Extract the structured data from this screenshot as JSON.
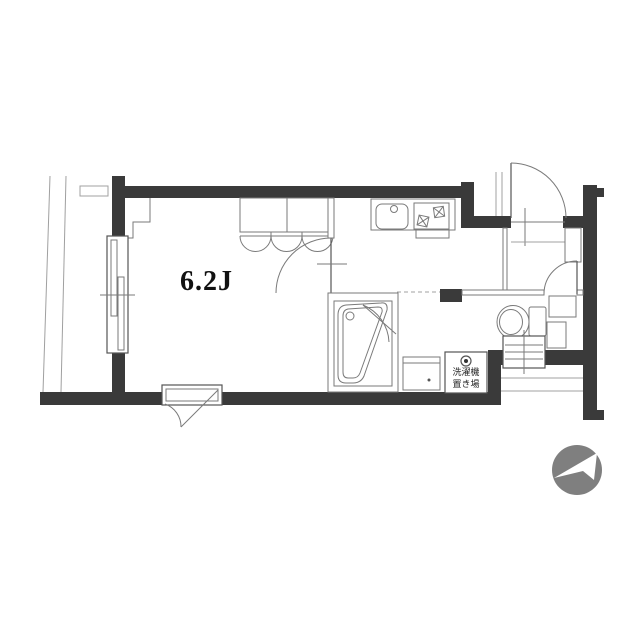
{
  "page": {
    "width": 640,
    "height": 640,
    "background": "#ffffff"
  },
  "floorplan": {
    "room_label": "6.2J",
    "washer_space_label_line1": "洗濯機",
    "washer_space_label_line2": "置き場",
    "compass_direction": "northeast"
  },
  "colors": {
    "wall": "#3a3a3a",
    "lineDark": "#555555",
    "lineMid": "#7a7a7a",
    "lineLight": "#a0a0a0",
    "bg": "#ffffff",
    "compass": "#7f7f7f",
    "ink": "#111111",
    "washerText": "#222222"
  }
}
